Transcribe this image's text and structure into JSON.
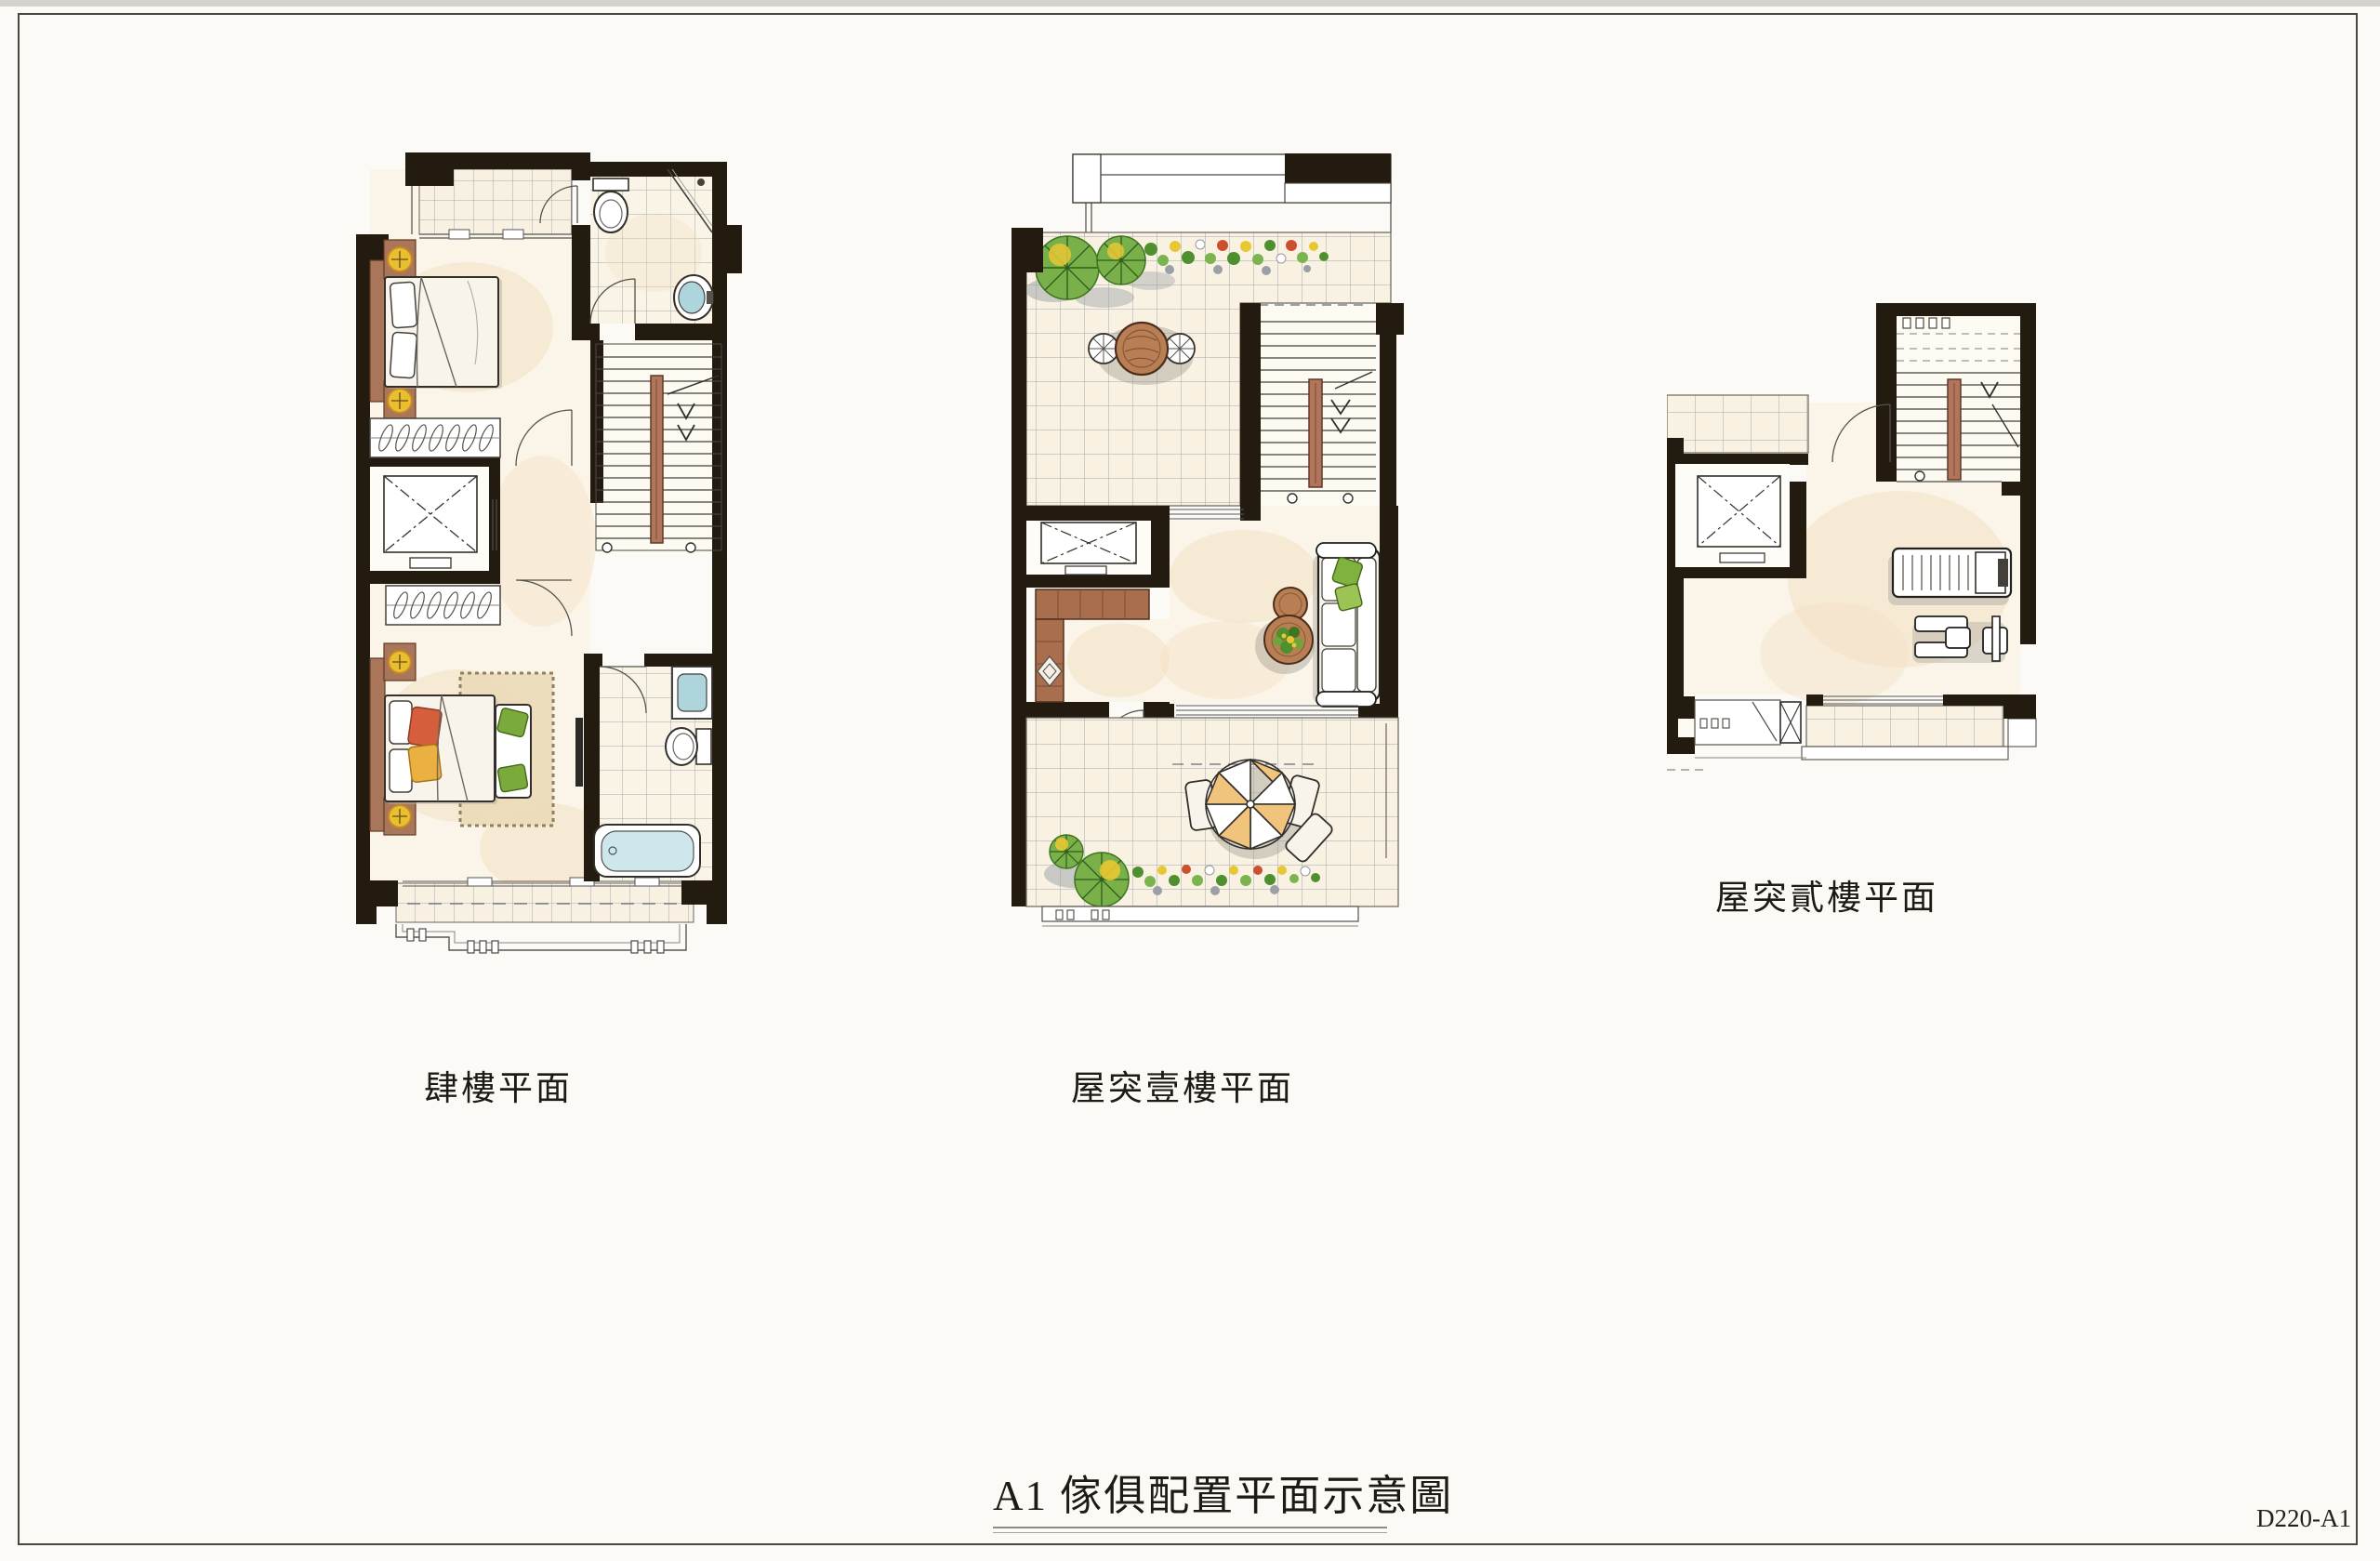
{
  "page": {
    "background": "#fbfaf6",
    "frame_color": "#4a463f"
  },
  "title": {
    "text": "A1 傢俱配置平面示意圖",
    "doc_number": "D220-A1"
  },
  "plans": [
    {
      "id": "plan-4f",
      "label": "肆樓平面",
      "features": [
        "bedroom",
        "bed",
        "closet",
        "bathroom",
        "toilet",
        "sink",
        "bathtub",
        "stairs",
        "elevator",
        "balcony",
        "rug",
        "bench",
        "tv"
      ]
    },
    {
      "id": "plan-roof1",
      "label": "屋突壹樓平面",
      "features": [
        "roof-terrace",
        "plants",
        "flower-bed",
        "outdoor-table",
        "chairs",
        "stairs",
        "elevator",
        "cabinet",
        "sofa",
        "coffee-table",
        "parasol-table",
        "balcony"
      ]
    },
    {
      "id": "plan-roof2",
      "label": "屋突貳樓平面",
      "features": [
        "roof-terrace",
        "stairs",
        "elevator",
        "treadmill",
        "exercise-bike",
        "balcony"
      ]
    }
  ],
  "colors": {
    "wall": "#241b10",
    "wood": "#a9765a",
    "wood_dark": "#5f3b26",
    "floor_cream": "#fbf5e9",
    "wash_peach": "#f3dfc2",
    "tile_line": "#9aa0aa",
    "plant_green": "#6fa33c",
    "plant_dark": "#3f7422",
    "accent_yellow": "#e8c02f",
    "fixture_blue": "#aed4dc",
    "pillow_red": "#d55f3d",
    "pillow_yellow": "#eab041",
    "pillow_green": "#7aa93c",
    "parasol_tan": "#f0c47c",
    "rug_tan": "#ecdcba",
    "shadow_grey": "#b2ada4"
  }
}
